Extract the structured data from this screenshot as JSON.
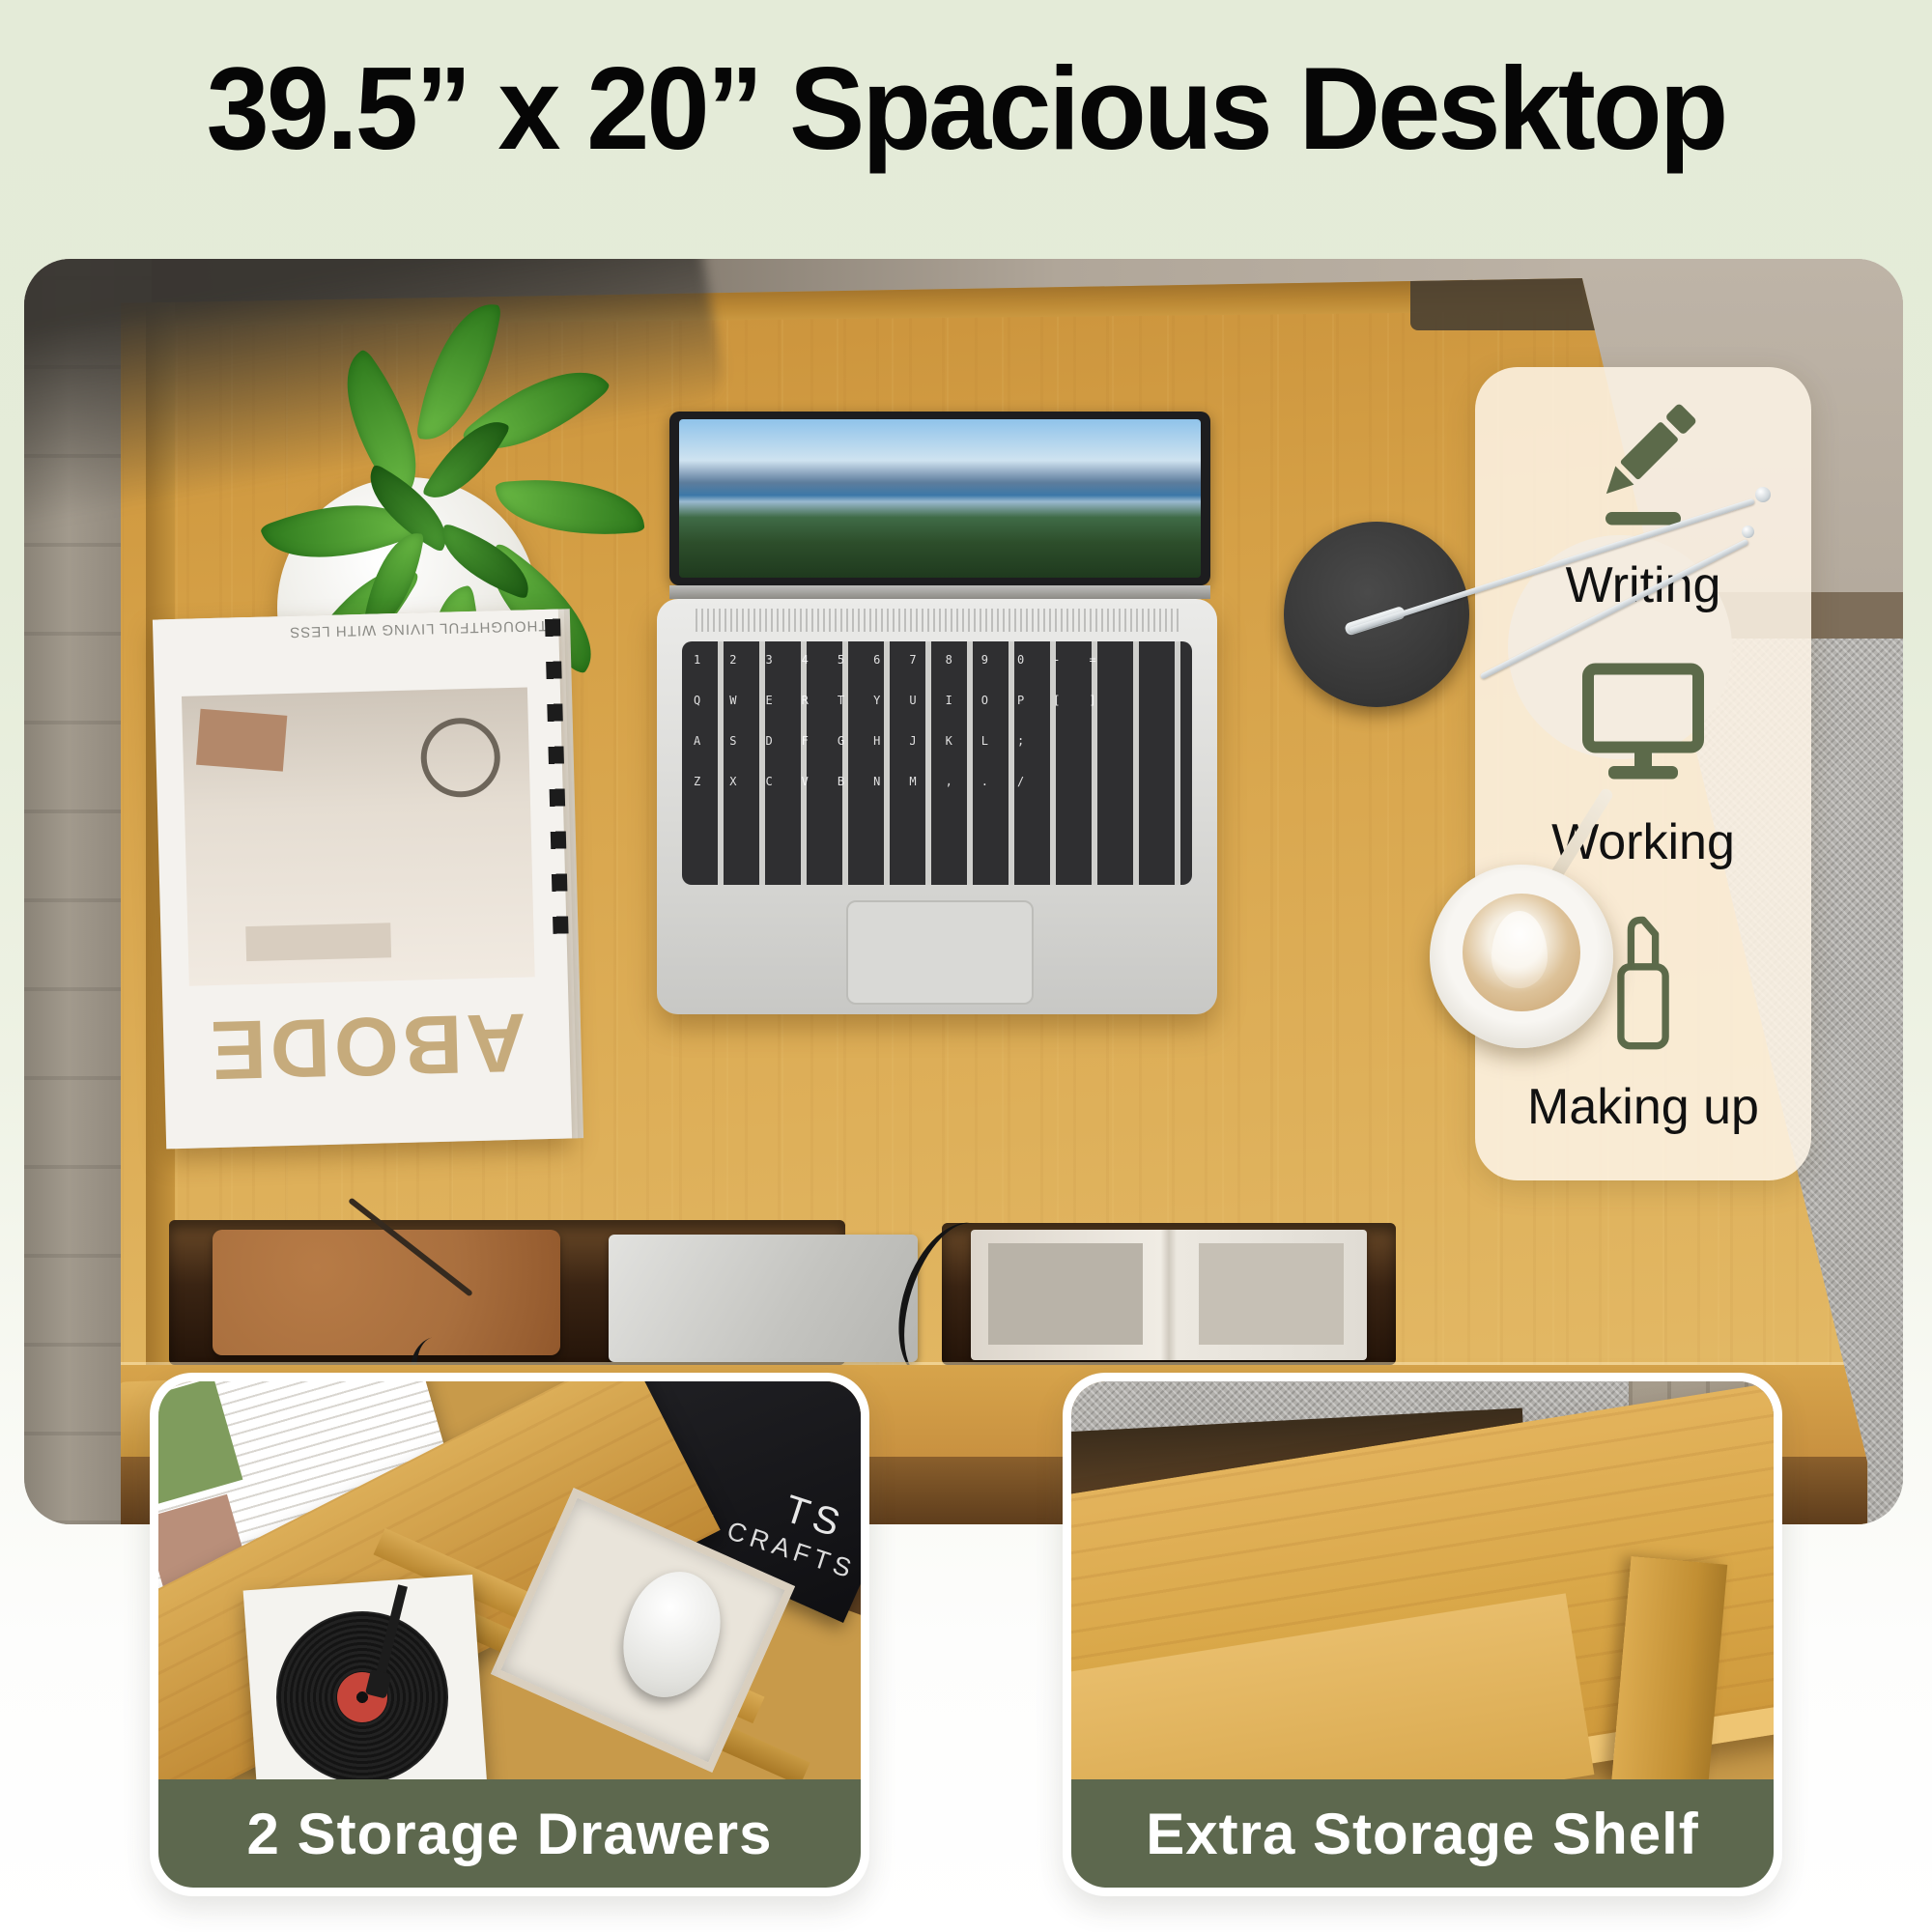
{
  "title": "39.5” x 20” Spacious Desktop",
  "overlay_panel": {
    "items": [
      {
        "label": "Writing",
        "icon": "pencil-icon"
      },
      {
        "label": "Working",
        "icon": "monitor-icon"
      },
      {
        "label": "Making up",
        "icon": "lipstick-icon"
      }
    ]
  },
  "insets": {
    "left": {
      "caption": "2 Storage Drawers"
    },
    "right": {
      "caption": "Extra Storage Shelf"
    }
  },
  "scene_text": {
    "magazine_title": "ABODE",
    "magazine_tagline": "THOUGHTFUL LIVING WITH LESS",
    "book_line1": "TS",
    "book_line2": "E CRAFTS"
  },
  "laptop": {
    "keyboard_rows": [
      "1234567890-=",
      "QWERTYUIOP[]",
      "ASDFGHJKL;",
      "ZXCVBNM,./"
    ]
  },
  "colors": {
    "background_top": "#e4ebd8",
    "caption_bg": "#5d684e",
    "caption_text": "#ffffff",
    "icon_olive": "#5c6a4a",
    "panel_bg": "rgba(253,244,230,0.87)",
    "title_text": "#060606",
    "desk_wood": "#d19d43"
  }
}
